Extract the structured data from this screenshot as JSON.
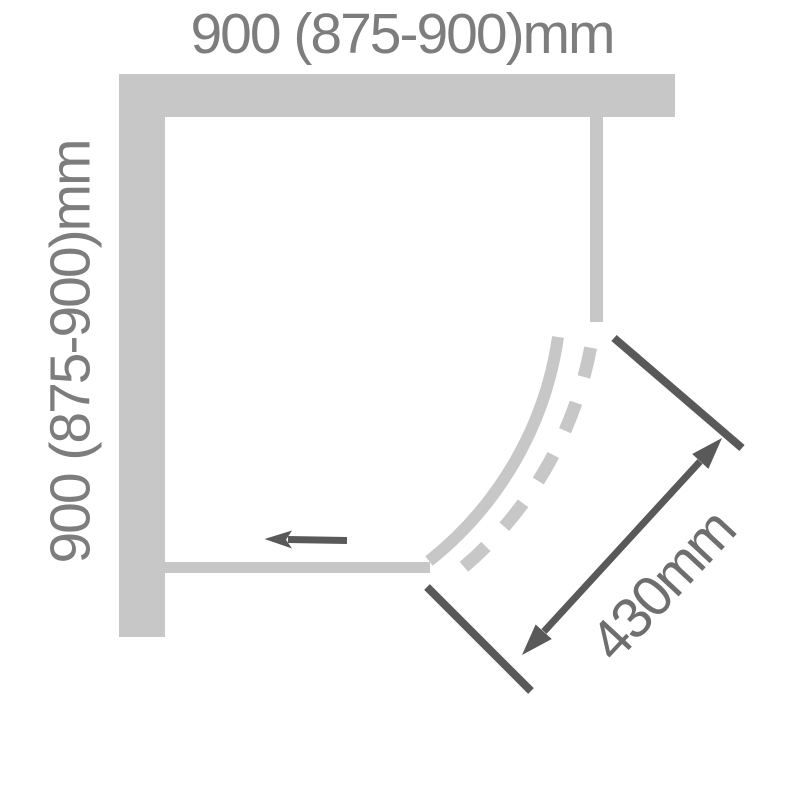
{
  "labels": {
    "top_width": "900 (875-900)mm",
    "left_height": "900 (875-900)mm",
    "diagonal_dimension": "430mm"
  },
  "colors": {
    "background": "#ffffff",
    "panel": "#c7c7c7",
    "dimension": "#595959",
    "label": "#7d7d7d",
    "diagonal_label": "#6e6e6e"
  },
  "shapes": {
    "top_wall": "horizontal-wall-bar",
    "left_wall": "vertical-wall-bar",
    "right_fixed_panel": "thin-vertical-panel-bar",
    "bottom_fixed_panel": "thin-horizontal-panel-bar",
    "curved_front_solid": "quarter-arc-solid",
    "door_travel_path": "quarter-arc-dashed",
    "slide_direction_arrow": "left-arrow",
    "dimension_arrow": "diagonal-double-headed-arrow",
    "dimension_ticks": "diagonal-tick-lines"
  }
}
